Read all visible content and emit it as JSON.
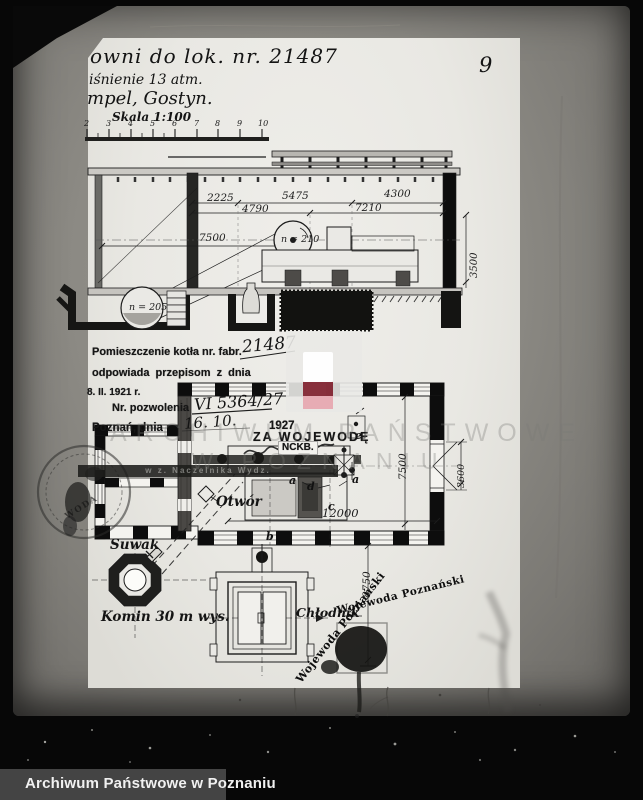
{
  "colors": {
    "paper": "#eae9e5",
    "backing": "#8d8b87",
    "ink": "#1c1c1c",
    "watermark_red_dark": "#7d1c29",
    "watermark_red_light": "#e7a9b1",
    "archive_bar_bg": "#474747"
  },
  "archive_bar": {
    "label": "Archiwum Państwowe w Poznaniu"
  },
  "photo": {
    "page_number": "9"
  },
  "document": {
    "title_line1": "owni  do lok. nr. 21487",
    "title_line2": "iśnienie 13 atm.",
    "title_line3": "mpel, Gostyn.",
    "scale_label": "Skala 1:100",
    "scale_ticks": [
      "2",
      "3",
      "4",
      "5",
      "6",
      "7",
      "8",
      "9",
      "10"
    ]
  },
  "section_view": {
    "dim_2225": "2225",
    "dim_5475": "5475",
    "dim_4300": "4300",
    "dim_4790": "4790",
    "dim_7210": "7210",
    "dim_7500": "7500",
    "dim_3500": "3500",
    "flywheel_label": "n = 210",
    "pit_wheel_label": "n = 205"
  },
  "approval_stamp": {
    "line1": "Pomieszczenie kotła nr. fabr.",
    "line1_hand": "21487",
    "line2": "odpowiada przepisom z dnia",
    "line3": "8. II. 1921 r.",
    "line4": "Nr. pozwolenia",
    "line4_hand": "VI 5364/27",
    "line5": "Poznań, dnia",
    "line5_hand": "16. 10.",
    "line5_year": "1927",
    "line6": "ZA WOJEWODĘ",
    "line7": "w z. Naczelnika Wydz."
  },
  "plan_view": {
    "room_label": "NCKB.",
    "dim_7500": "7500",
    "dim_3600": "3600",
    "dim_12000": "12000",
    "dim_8750": "8750",
    "marker_a": "a",
    "marker_b": "b",
    "marker_c": "c",
    "marker_d": "d",
    "marker_e": "e",
    "otwor_label": "Otwór",
    "suwak_label": "Suwak",
    "komin_label": "Komin 30 m wys.",
    "chlodnik_label": "Chłodnik"
  },
  "stamps": {
    "diagonal_text": "Wojewoda Poznański",
    "round_fragment": "WODA"
  },
  "watermark": {
    "line1": "ARCHIWUM PAŃSTWOWE",
    "line2": "W POZNANIU"
  }
}
